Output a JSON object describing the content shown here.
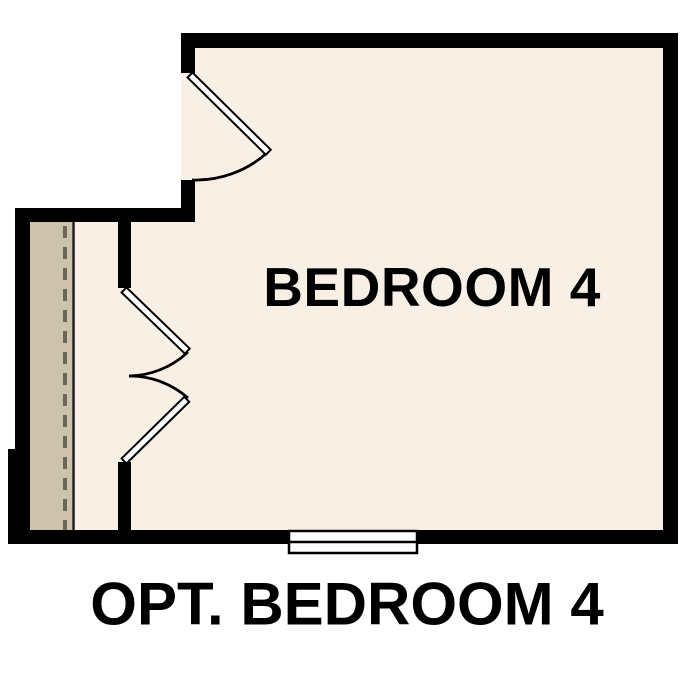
{
  "figure": {
    "type": "floor-plan",
    "room": {
      "label": "BEDROOM 4"
    },
    "caption": {
      "text": "OPT. BEDROOM 4"
    },
    "features": [
      "single-swing-door",
      "double-swing-door",
      "window",
      "hall-strip-with-dashed-line"
    ]
  },
  "colors": {
    "background": "#ffffff",
    "wall": "#000000",
    "floor": "#f8f0e5",
    "hall_floor": "#cdc3aa",
    "hall_edge_line": "#1c1c1c",
    "dash_line": "#6c6655",
    "door_leaf": "#ffffff",
    "door_outline": "#000000",
    "window_fill": "#ffffff",
    "text": "#000000"
  }
}
